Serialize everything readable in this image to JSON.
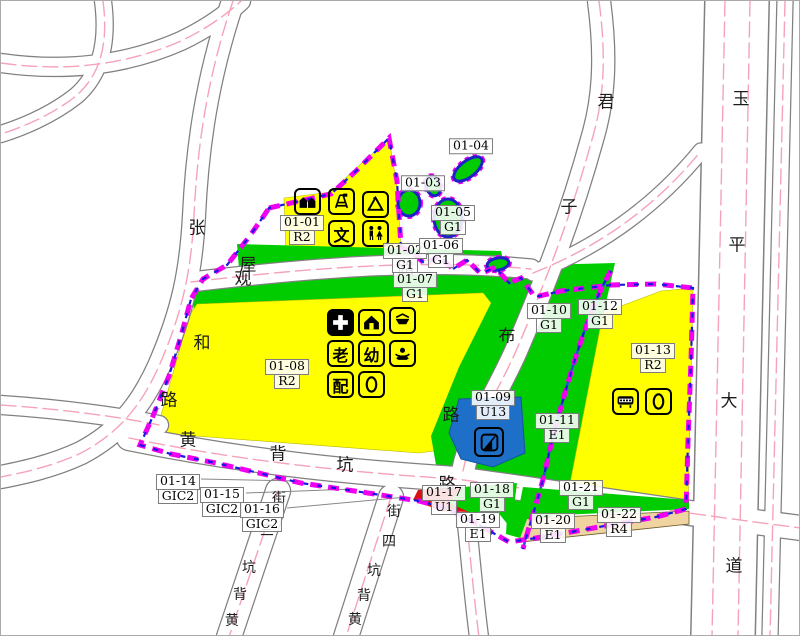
{
  "map_title": "zoning-plan-sheet",
  "palette": {
    "residential_yellow": "#FFFF00",
    "green_space_green": "#00CC00",
    "utility_blue": "#1E6FC8",
    "red_parcel": "#DD1010",
    "tan_parcel": "#EFD3A0",
    "boundary_magenta": "#F000F0",
    "boundary_blue": "#1818E0",
    "river_blue": "#2B4FD8",
    "road_centerline_pink": "#F5A3B8",
    "road_casing_gray": "#808080"
  },
  "parcels": [
    {
      "code": "01-01",
      "use": "R2"
    },
    {
      "code": "01-02",
      "use": "G1"
    },
    {
      "code": "01-03",
      "use": ""
    },
    {
      "code": "01-04",
      "use": ""
    },
    {
      "code": "01-05",
      "use": "G1"
    },
    {
      "code": "01-06",
      "use": "G1"
    },
    {
      "code": "01-07",
      "use": "G1"
    },
    {
      "code": "01-08",
      "use": "R2"
    },
    {
      "code": "01-09",
      "use": "U13"
    },
    {
      "code": "01-10",
      "use": "G1"
    },
    {
      "code": "01-11",
      "use": "E1"
    },
    {
      "code": "01-12",
      "use": "G1"
    },
    {
      "code": "01-13",
      "use": "R2"
    },
    {
      "code": "01-14",
      "use": "GIC2"
    },
    {
      "code": "01-15",
      "use": "GIC2"
    },
    {
      "code": "01-16",
      "use": "GIC2"
    },
    {
      "code": "01-17",
      "use": "U1"
    },
    {
      "code": "01-18",
      "use": "G1"
    },
    {
      "code": "01-19",
      "use": "E1"
    },
    {
      "code": "01-20",
      "use": "E1"
    },
    {
      "code": "01-21",
      "use": "G1"
    },
    {
      "code": "01-22",
      "use": "R4"
    }
  ],
  "roads": [
    {
      "name": "zhang-guan-he-road",
      "chars": [
        "张",
        "观",
        "和",
        "路"
      ]
    },
    {
      "name": "wubei-road",
      "chars": [
        "屋",
        "路"
      ]
    },
    {
      "name": "junzibu-road",
      "chars": [
        "君",
        "子",
        "布",
        "路"
      ]
    },
    {
      "name": "huangbeikeng-road",
      "chars": [
        "黄",
        "背",
        "坑",
        "路"
      ]
    },
    {
      "name": "yuping-avenue",
      "chars": [
        "玉",
        "平",
        "大",
        "道"
      ]
    },
    {
      "name": "huangbeikeng-lane-3",
      "chars": [
        "街",
        "三",
        "坑",
        "背",
        "黄"
      ]
    },
    {
      "name": "huangbeikeng-lane-4",
      "chars": [
        "街",
        "四",
        "坑",
        "背",
        "黄"
      ]
    }
  ],
  "icons": {
    "culture_char": "文",
    "elderly_char": "老",
    "kindergarten_char": "幼",
    "distribution_char": "配"
  }
}
